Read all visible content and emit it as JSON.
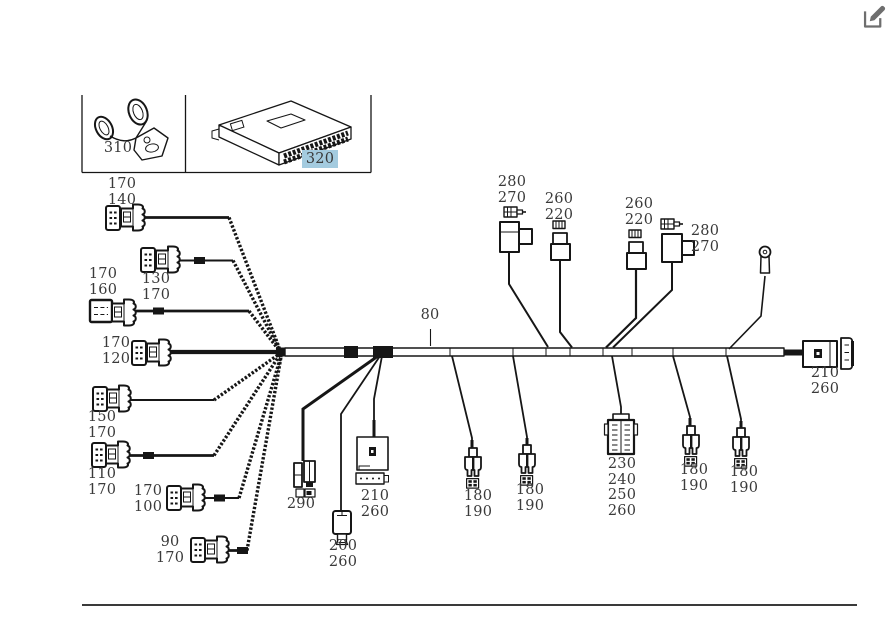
{
  "colors": {
    "background": "#ffffff",
    "highlight_bg": "#a4cbdf",
    "label_text": "#3a3a3a",
    "diagram_line": "#161616",
    "icon_gray": "#6e6e6e"
  },
  "header": {
    "edit_icon": "edit-icon"
  },
  "parts_box": {
    "items": [
      {
        "number": "310",
        "highlighted": false,
        "drawing": "cable-clip-bracket"
      },
      {
        "number": "320",
        "highlighted": true,
        "drawing": "control-unit-ecu"
      }
    ]
  },
  "diagram": {
    "type": "wiring-harness",
    "trunk_label": "80",
    "callouts": [
      {
        "id": "connector-170-140",
        "text": "170\n140"
      },
      {
        "id": "connector-130-170",
        "text": "130\n170"
      },
      {
        "id": "connector-170-160",
        "text": "170\n160"
      },
      {
        "id": "connector-170-120",
        "text": "170\n120"
      },
      {
        "id": "connector-150-170",
        "text": "150\n170"
      },
      {
        "id": "connector-110-170",
        "text": "110\n170"
      },
      {
        "id": "connector-170-100",
        "text": "170\n100"
      },
      {
        "id": "connector-90-170",
        "text": "90\n170"
      },
      {
        "id": "connector-290",
        "text": "290"
      },
      {
        "id": "relay-210-260",
        "text": "210\n260"
      },
      {
        "id": "connector-200-260",
        "text": "200\n260"
      },
      {
        "id": "connector-180-190-a",
        "text": "180\n190"
      },
      {
        "id": "connector-180-190-b",
        "text": "180\n190"
      },
      {
        "id": "connector-280-270-left",
        "text": "280\n270"
      },
      {
        "id": "connector-260-220-left",
        "text": "260\n220"
      },
      {
        "id": "connector-260-220-right",
        "text": "260\n220"
      },
      {
        "id": "connector-280-270-right",
        "text": "280\n270"
      },
      {
        "id": "connector-230-240-250-260",
        "text": "230\n240\n250\n260"
      },
      {
        "id": "connector-180-190-c",
        "text": "180\n190"
      },
      {
        "id": "connector-180-190-d",
        "text": "180\n190"
      },
      {
        "id": "connector-210-260-right",
        "text": "210\n260"
      }
    ]
  }
}
